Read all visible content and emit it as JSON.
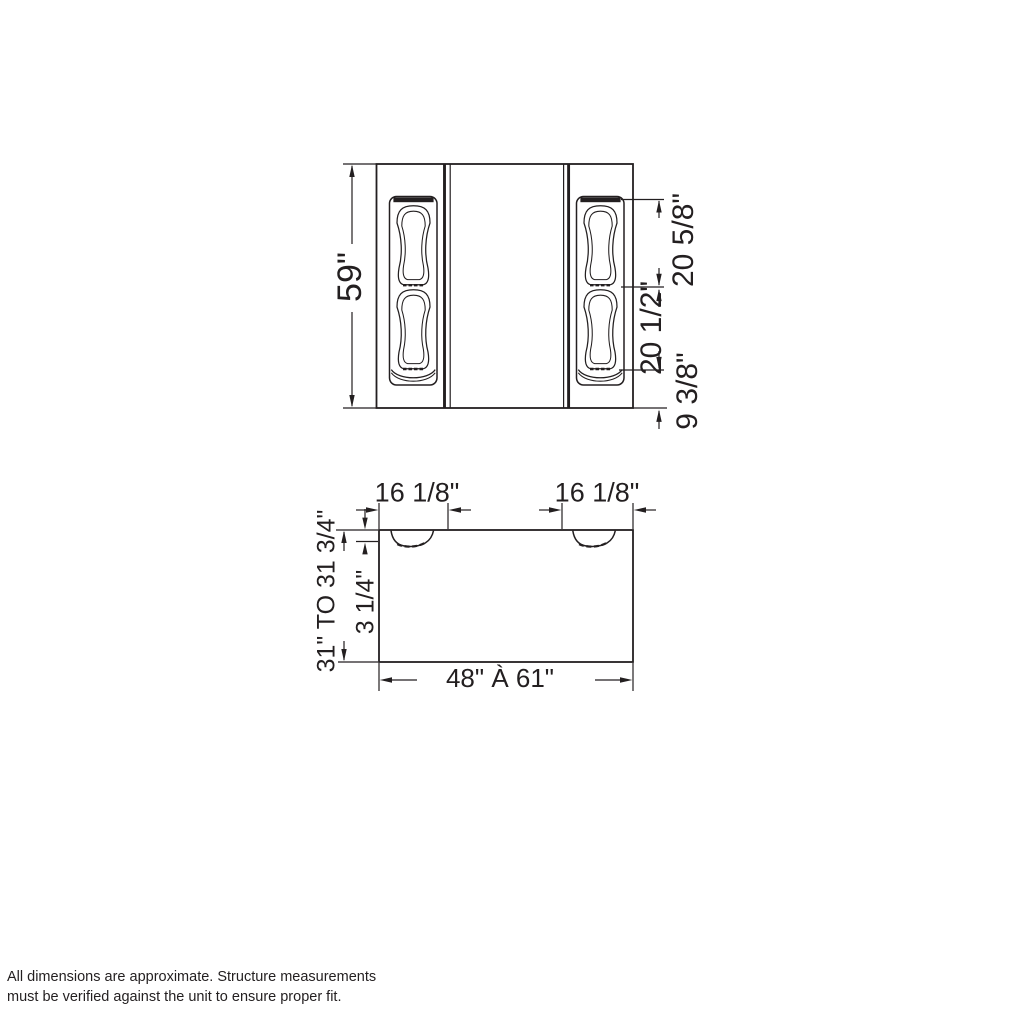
{
  "colors": {
    "line": "#231f20",
    "text": "#231f20",
    "background": "#ffffff"
  },
  "top_view": {
    "overall_depth": "59\"",
    "upper_seat_length": "20 5/8\"",
    "lower_seat_length": "20 1/2\"",
    "bottom_edge_offset": "9 3/8\""
  },
  "front_view": {
    "left_inset": "16 1/8\"",
    "right_inset": "16 1/8\"",
    "height_range": "31\" TO 31 3/4\"",
    "recess_depth": "3 1/4\"",
    "width_range": "48\" À 61\""
  },
  "footer": {
    "line1": "All dimensions are approximate. Structure measurements",
    "line2": "must be verified against the unit to ensure proper fit."
  }
}
